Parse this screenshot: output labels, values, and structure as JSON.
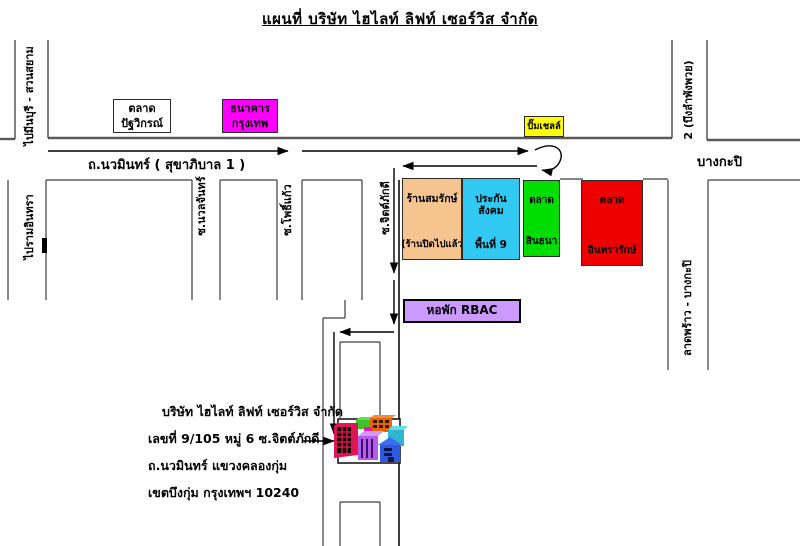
{
  "title": "แผนที่ บริษัท ไฮไลท์ ลิฟท์ เซอร์วิส จำกัด",
  "roads": {
    "main_road": "ถ.นวมินทร์ ( สุขาภิบาล 1 )",
    "to_minburi": "ไปมีนบุรี - สวนสยาม",
    "to_bueng_lam_phang_phuai": "2 (บึงลำพังพวย)",
    "bang_kapi": "บางกะปิ",
    "to_ram_inthra": "ไปรามอินทรา",
    "soi_nuan_chan": "ซ.นวลจันทร์",
    "soi_pho_kaeo": "ซ.โพธิ์แก้ว",
    "soi_chit_phakdi": "ซ.จิตต์ภักดี",
    "lat_phrao_bang_kapi": "ลาดพร้าว - บางกะปิ"
  },
  "landmarks": {
    "patwikorn_market": {
      "line1": "ตลาด",
      "line2": "ปัฐวิกรณ์",
      "color": "#ffffff"
    },
    "bangkok_bank": {
      "line1": "ธนาคาร",
      "line2": "กรุงเทพ",
      "color": "#ff00ff"
    },
    "shell_station": {
      "label": "ปั๊มเชลล์",
      "color": "#ffff00"
    },
    "somrak_shop": {
      "line1": "ร้านสมรักษ์",
      "line2": "(ร้านปิดไปแล้ว",
      "color": "#f6c58f"
    },
    "social_security_area9": {
      "line1": "ประกันสังคม",
      "line2": "พื้นที่ 9",
      "color": "#31c9f2"
    },
    "sinthana_market": {
      "line1": "ตลาด",
      "line2": "สินธนา",
      "color": "#00dd00"
    },
    "inthararak_market": {
      "line1": "ตลาด",
      "line2": "อินทรารักษ์",
      "color": "#ee0000"
    },
    "rbac_dorm": {
      "label": "หอพัก RBAC",
      "color": "#cc99ff"
    }
  },
  "company": {
    "name": "บริษัท ไฮไลท์ ลิฟท์ เซอร์วิส จำกัด",
    "address_line2": "เลขที่ 9/105 หมู่ 6 ซ.จิตต์ภักดี",
    "address_line3": "ถ.นวมินทร์ แขวงคลองกุ่ม",
    "address_line4": "เขตบึงกุ่ม กรุงเทพฯ 10240"
  }
}
